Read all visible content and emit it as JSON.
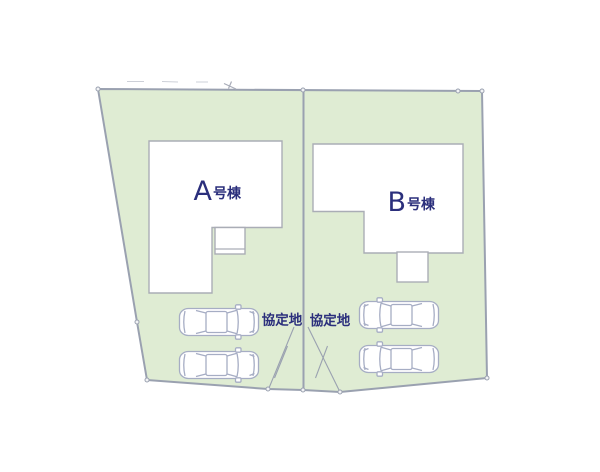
{
  "site_plan": {
    "buildings": [
      {
        "letter": "A",
        "suffix": "号棟"
      },
      {
        "letter": "B",
        "suffix": "号棟"
      }
    ],
    "agreement_areas": [
      {
        "label": "協定地"
      },
      {
        "label": "協定地"
      }
    ],
    "cars": {
      "count": 4,
      "icon": "car-top-view-icon"
    },
    "colors": {
      "lot_fill": "#dfecd3",
      "lot_boundary": "#9aa1b0",
      "house_fill": "#ffffff",
      "house_stroke": "#aaadb6",
      "car_stroke": "#a6adc4",
      "label_text": "#2b2f7c",
      "marker_fill": "#f2f3f5",
      "dash": "#cdd0d8"
    }
  }
}
